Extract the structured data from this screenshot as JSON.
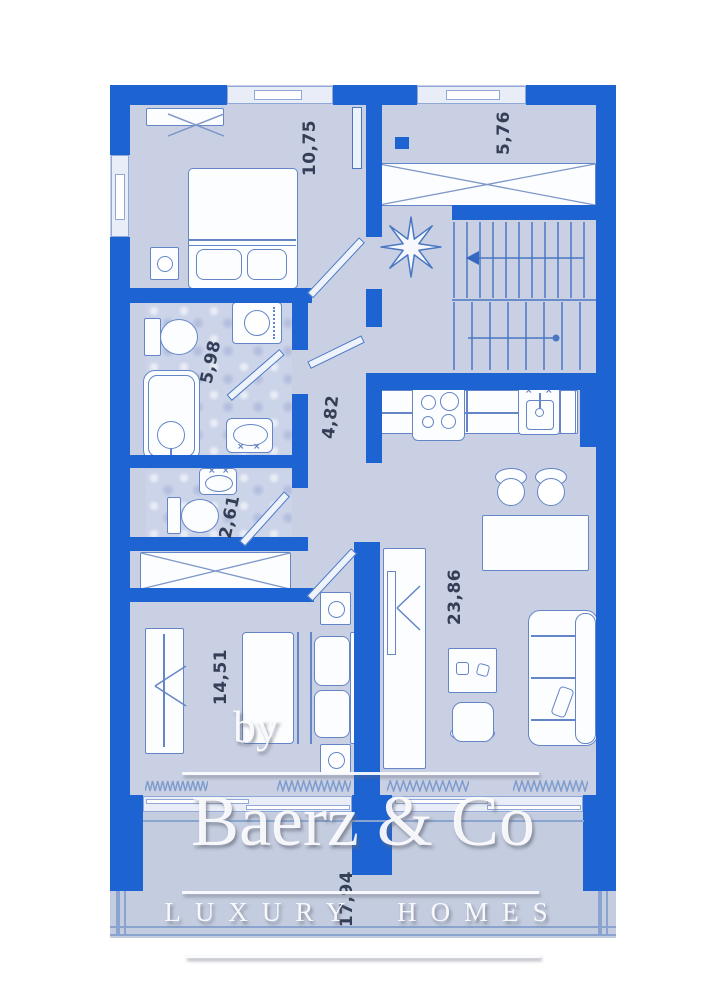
{
  "plan": {
    "rooms": [
      {
        "id": "bedroom-1",
        "area": "10,75"
      },
      {
        "id": "entry-hall",
        "area": "5,76"
      },
      {
        "id": "bathroom",
        "area": "5,98"
      },
      {
        "id": "hallway",
        "area": "4,82"
      },
      {
        "id": "wc",
        "area": "2,61"
      },
      {
        "id": "living-kitchen",
        "area": "23,86"
      },
      {
        "id": "bedroom-2",
        "area": "14,51"
      },
      {
        "id": "terrace",
        "area": "17,94"
      }
    ]
  },
  "watermark": {
    "prefix": "by",
    "brand": "Baerz & Co",
    "tagline": "LUXURY HOMES"
  },
  "colors": {
    "wall_blue": "#1e63d2",
    "floor_blue": "#c9d0e3",
    "furniture_outline": "#6486c6",
    "label_text": "#343e56",
    "background": "#ffffff"
  }
}
